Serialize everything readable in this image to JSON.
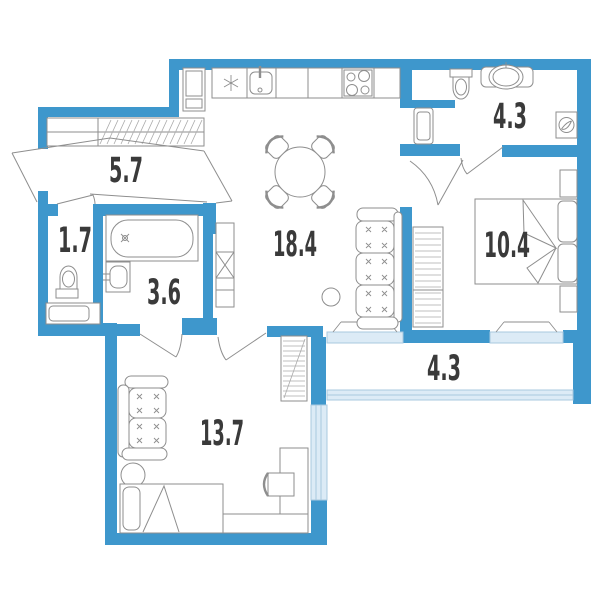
{
  "plan_title": "Apartment floor plan",
  "colors": {
    "wall": "#3E97CC",
    "window_fill": "#DCEBF6",
    "window_line": "#A8C8DF",
    "furniture_line": "#8E8E8E",
    "label": "#3A3A3A",
    "background": "#FFFFFF"
  },
  "rooms": [
    {
      "id": "hallway",
      "area": "5.7"
    },
    {
      "id": "wc",
      "area": "1.7"
    },
    {
      "id": "bathroom",
      "area": "3.6"
    },
    {
      "id": "kitchen-living",
      "area": "18.4"
    },
    {
      "id": "bathroom-2",
      "area": "4.3"
    },
    {
      "id": "bedroom",
      "area": "10.4"
    },
    {
      "id": "balcony",
      "area": "4.3"
    },
    {
      "id": "living-room",
      "area": "13.7"
    }
  ]
}
